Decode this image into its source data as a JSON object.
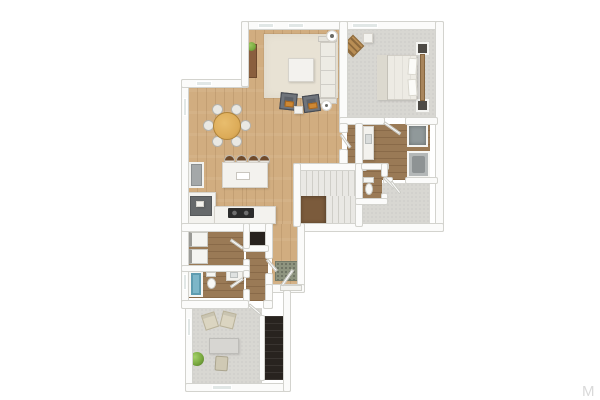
{
  "watermark": {
    "text": "M"
  },
  "palette": {
    "wall": "#fbfbfa",
    "wall-edge": "#d3d3ce",
    "wood-main": "#d1ad80",
    "wood-dark": "#9a7a56",
    "carpet": "#d8d7d2",
    "rug": "#e8e2d4",
    "stairs-void": "#7b5b3c",
    "dark-floor": "#28231f",
    "teal": "#7db6c8",
    "plant": "#79a93f",
    "mat": "#8e947f",
    "accent-orange": "#ce8833",
    "chair-gray": "#5c6169",
    "table-wood": "#dcab58",
    "white-furniture": "#f3f2ee",
    "appliance-gray": "#a4a8a9",
    "bed-wood": "#a8855c",
    "chair-beige": "#dbd5c1",
    "counter-dark": "#66696b",
    "watermark-color": "#d9d9d9"
  },
  "floorplan": {
    "type": "3d-top-down-floor-plan-rendering",
    "rooms": [
      {
        "name": "Living Room",
        "floor": "hardwood",
        "furniture": [
          "area-rug",
          "sofa",
          "ottoman-coffee-table",
          "armchair",
          "armchair",
          "media-console",
          "plant",
          "round-side-table",
          "round-side-table",
          "small-table"
        ]
      },
      {
        "name": "Dining Area",
        "floor": "hardwood",
        "furniture": [
          "round-dining-table",
          "dining-chair-x6"
        ]
      },
      {
        "name": "Kitchen",
        "floor": "hardwood",
        "furniture": [
          "island",
          "bar-stool-x4",
          "cooktop-counter",
          "corner-counter",
          "refrigerator"
        ]
      },
      {
        "name": "Bedroom",
        "floor": "carpet",
        "furniture": [
          "bed",
          "headboard",
          "nightstand-x2",
          "accent-chair",
          "cube-table"
        ]
      },
      {
        "name": "Master Bathroom",
        "floor": "hardwood",
        "furniture": [
          "vanity",
          "shower",
          "tub-unit"
        ]
      },
      {
        "name": "Water Closet",
        "floor": "hardwood",
        "furniture": [
          "toilet"
        ]
      },
      {
        "name": "Walk-in Closet",
        "floor": "carpet",
        "furniture": []
      },
      {
        "name": "Staircase",
        "floor": "stairs",
        "furniture": [
          "upper-flight",
          "lower-flight",
          "open-landing"
        ]
      },
      {
        "name": "Laundry Room",
        "floor": "hardwood",
        "furniture": [
          "washer",
          "dryer"
        ]
      },
      {
        "name": "Hall Bathroom",
        "floor": "hardwood",
        "furniture": [
          "bathtub",
          "toilet",
          "vanity"
        ]
      },
      {
        "name": "Entry Hall",
        "floor": "hardwood",
        "furniture": [
          "doormat",
          "front-door"
        ]
      },
      {
        "name": "Office",
        "floor": "carpet",
        "furniture": [
          "armchair",
          "armchair",
          "desk",
          "desk-chair",
          "plant",
          "dark-stairwell"
        ]
      }
    ]
  }
}
